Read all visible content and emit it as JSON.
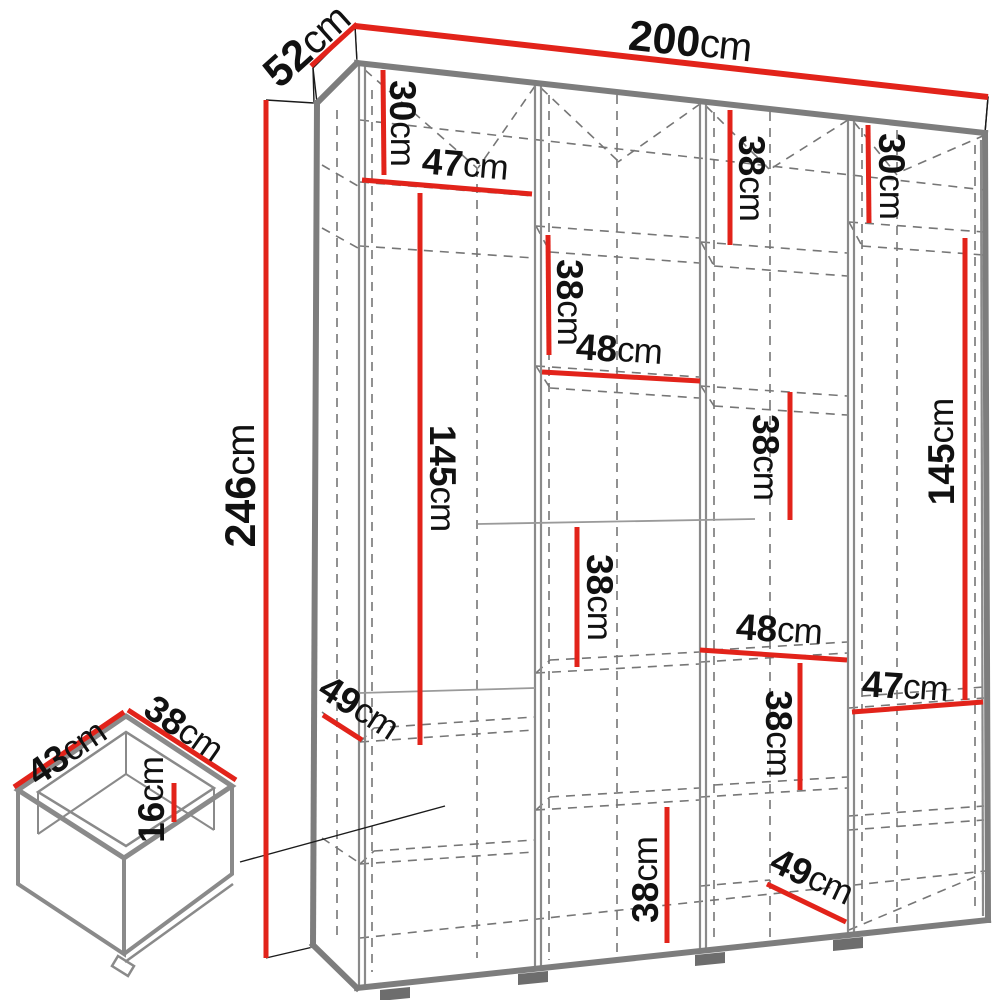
{
  "diagram": {
    "type": "furniture-dimension-diagram",
    "subject": "wardrobe with internal shelf layout and drawer detail",
    "unit": "cm",
    "colors": {
      "dimension_line": "#e2231a",
      "structure_gray": "#7d7d7d",
      "label_text": "#111111",
      "background": "#ffffff"
    },
    "overall": {
      "width_cm": 200,
      "depth_cm": 52,
      "height_cm": 246
    },
    "drawer": {
      "width_cm": 43,
      "depth_cm": 38,
      "height_cm": 16
    },
    "dims": {
      "w200": {
        "num": "200",
        "unit": "cm"
      },
      "d52": {
        "num": "52",
        "unit": "cm"
      },
      "h246": {
        "num": "246",
        "unit": "cm"
      },
      "t30l": {
        "num": "30",
        "unit": "cm"
      },
      "s47a": {
        "num": "47",
        "unit": "cm"
      },
      "b38top": {
        "num": "38",
        "unit": "cm"
      },
      "c38top": {
        "num": "38",
        "unit": "cm"
      },
      "t30r": {
        "num": "30",
        "unit": "cm"
      },
      "l145": {
        "num": "145",
        "unit": "cm"
      },
      "r145": {
        "num": "145",
        "unit": "cm"
      },
      "c38mid": {
        "num": "38",
        "unit": "cm"
      },
      "b48": {
        "num": "48",
        "unit": "cm"
      },
      "b38mid": {
        "num": "38",
        "unit": "cm"
      },
      "c48": {
        "num": "48",
        "unit": "cm"
      },
      "d47b": {
        "num": "47",
        "unit": "cm"
      },
      "c38bot": {
        "num": "38",
        "unit": "cm"
      },
      "b38bot": {
        "num": "38",
        "unit": "cm"
      },
      "c49bot": {
        "num": "49",
        "unit": "cm"
      },
      "a49": {
        "num": "49",
        "unit": "cm"
      },
      "dr43": {
        "num": "43",
        "unit": "cm"
      },
      "dr38": {
        "num": "38",
        "unit": "cm"
      },
      "dr16": {
        "num": "16",
        "unit": "cm"
      }
    }
  }
}
